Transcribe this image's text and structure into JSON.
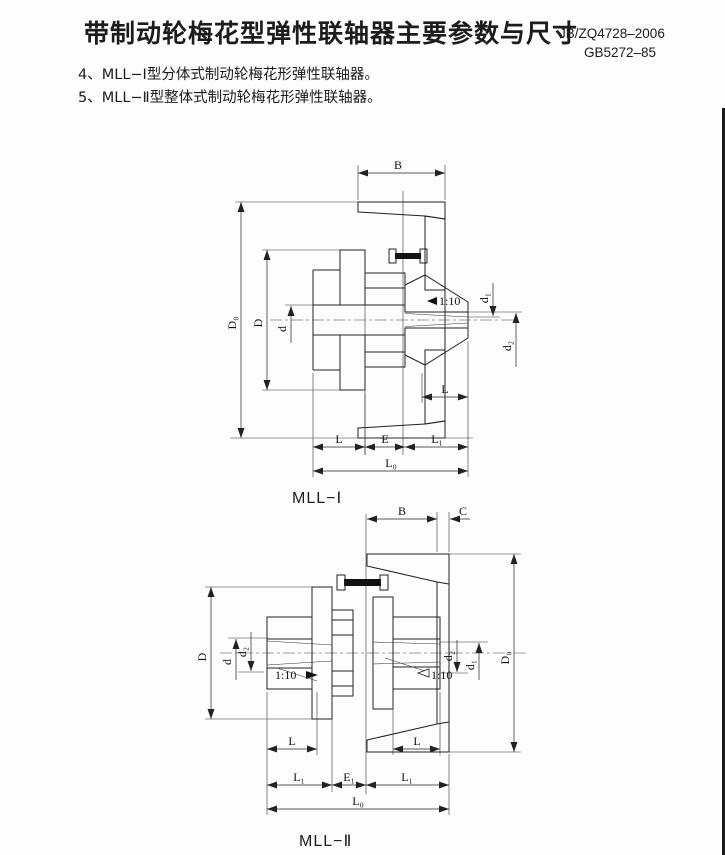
{
  "header": {
    "title": "带制动轮梅花型弹性联轴器主要参数与尺寸",
    "standard_1": "JB/ZQ4728–2006",
    "standard_2": "GB5272–85"
  },
  "notes": {
    "item_4": "4、MLL−Ⅰ型分体式制动轮梅花形弹性联轴器。",
    "item_5": "5、MLL−Ⅱ型整体式制动轮梅花形弹性联轴器。"
  },
  "labels": {
    "B": "B",
    "C": "C",
    "D": "D",
    "D0": "D₀",
    "d": "d",
    "d1": "d₁",
    "d2": "d₂",
    "L": "L",
    "L1": "L₁",
    "L0": "L₀",
    "E": "E",
    "E1": "E₁",
    "taper": "1:10"
  },
  "drawing1": {
    "caption": "MLL−Ⅰ"
  },
  "drawing2": {
    "caption": "MLL−Ⅱ"
  },
  "colors": {
    "ink": "#1c1c1c",
    "paper": "#fdfdfd"
  }
}
